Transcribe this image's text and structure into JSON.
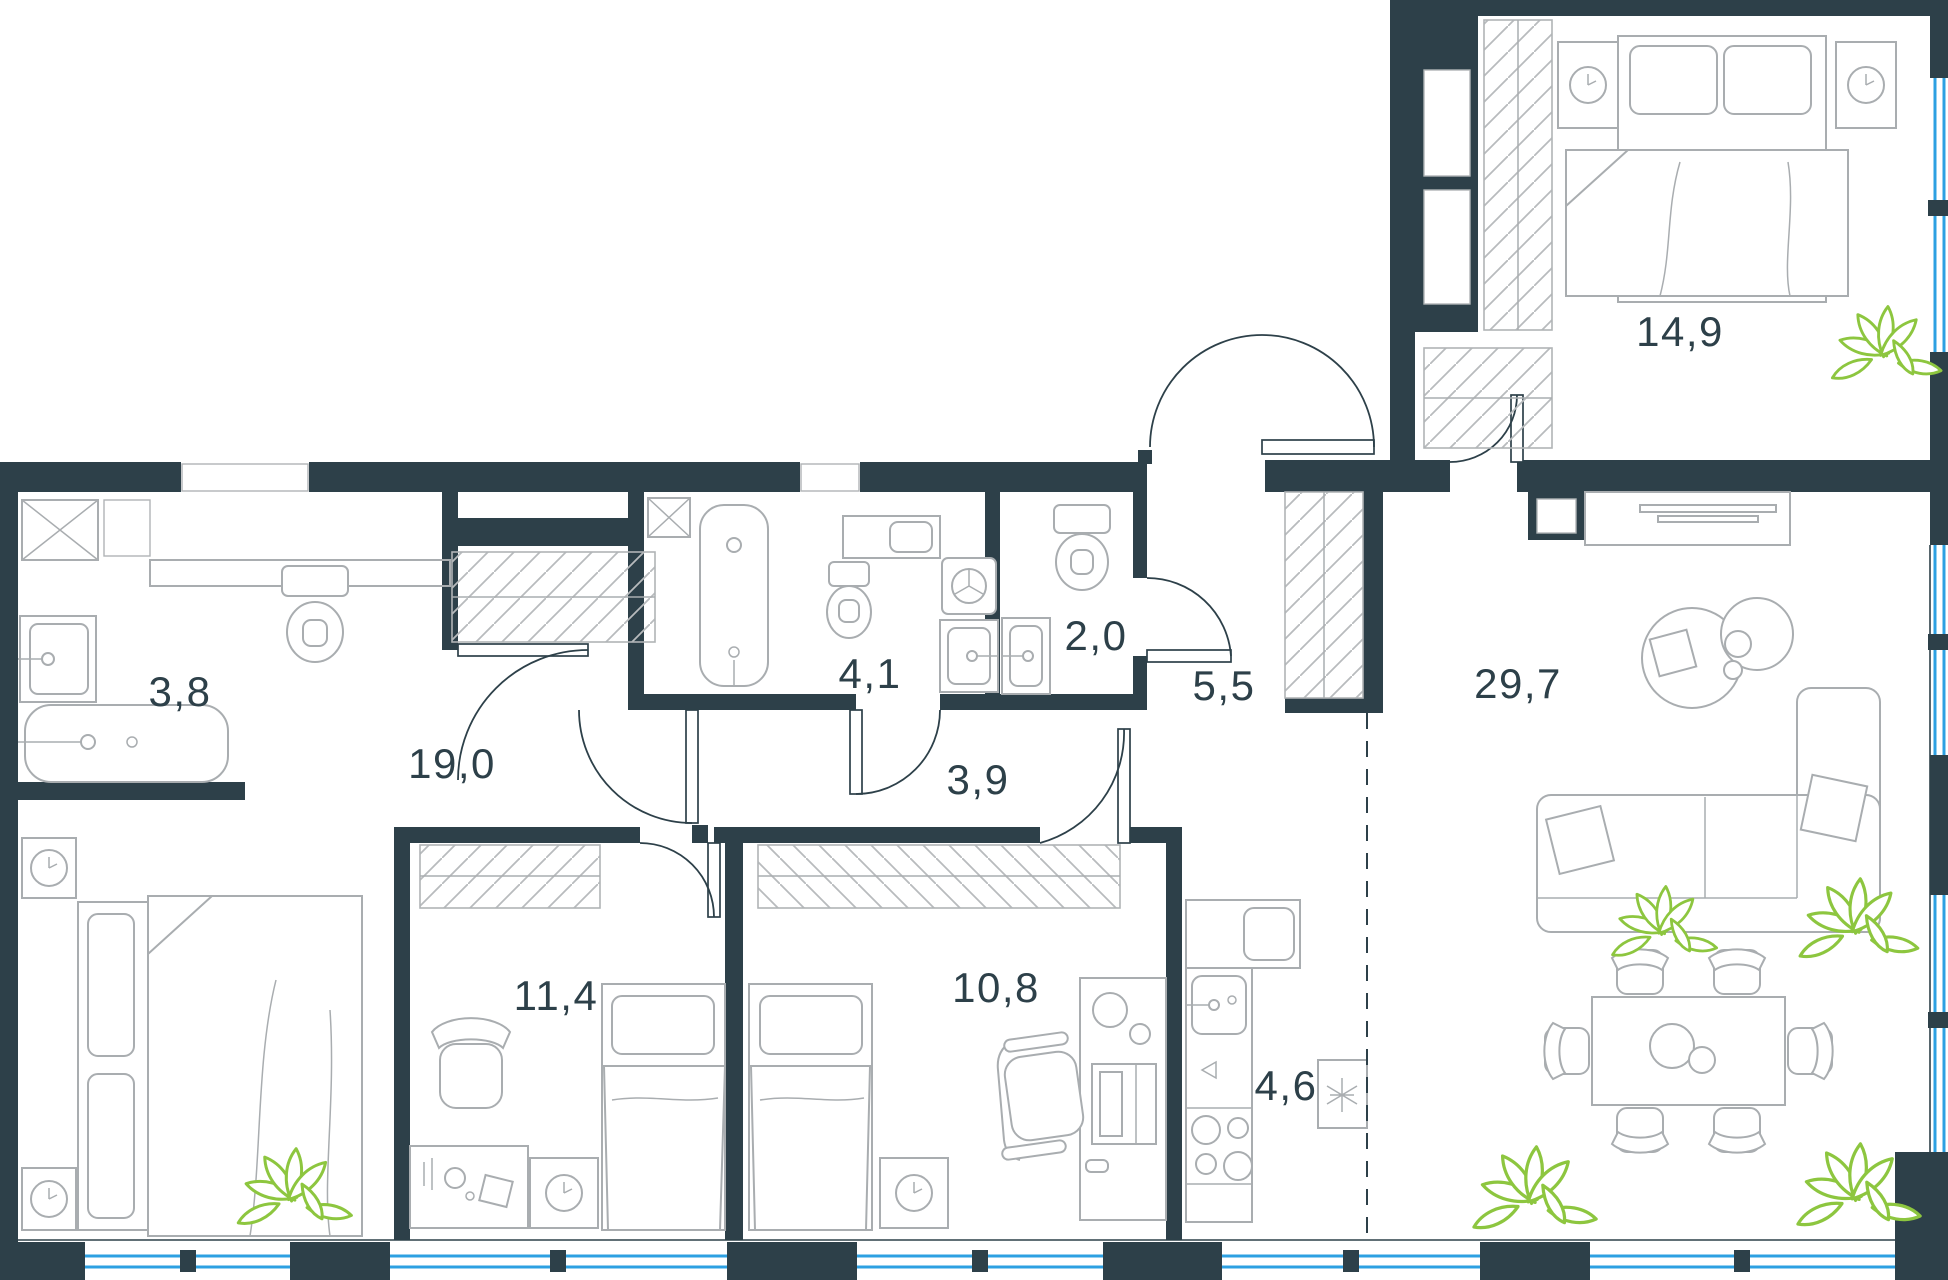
{
  "plan": {
    "type": "apartment-floor-plan",
    "rooms": [
      {
        "id": "bathroom-main",
        "area": "3,8"
      },
      {
        "id": "bedroom-master",
        "area": "19,0"
      },
      {
        "id": "bathroom-family",
        "area": "4,1"
      },
      {
        "id": "wc-guest",
        "area": "2,0"
      },
      {
        "id": "hallway-entry",
        "area": "5,5"
      },
      {
        "id": "corridor",
        "area": "3,9"
      },
      {
        "id": "living-dining",
        "area": "29,7"
      },
      {
        "id": "bedroom-right",
        "area": "14,9"
      },
      {
        "id": "bedroom-left",
        "area": "11,4"
      },
      {
        "id": "bedroom-middle",
        "area": "10,8"
      },
      {
        "id": "kitchen",
        "area": "4,6"
      }
    ],
    "colors": {
      "wall": "#2d4049",
      "window": "#2da0e2",
      "plant": "#8dc63f",
      "furniture": "#a9adb0",
      "hatch": "#b8bbbd",
      "label": "#2d4049"
    }
  }
}
